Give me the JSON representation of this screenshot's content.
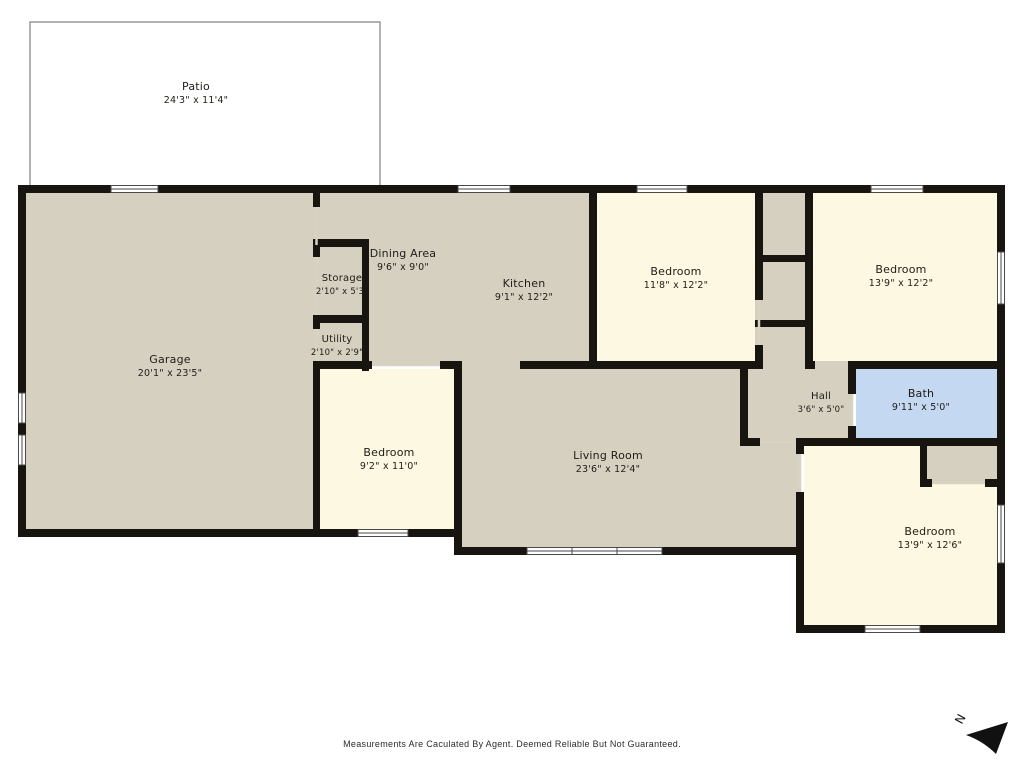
{
  "plan": {
    "rooms": {
      "patio": {
        "name": "Patio",
        "dims": "24'3\" x 11'4\""
      },
      "garage": {
        "name": "Garage",
        "dims": "20'1\" x 23'5\""
      },
      "storage": {
        "name": "Storage",
        "dims": "2'10\" x 5'3\""
      },
      "dining": {
        "name": "Dining Area",
        "dims": "9'6\" x 9'0\""
      },
      "kitchen": {
        "name": "Kitchen",
        "dims": "9'1\" x 12'2\""
      },
      "utility": {
        "name": "Utility",
        "dims": "2'10\" x 2'9\""
      },
      "bedroom_top_mid": {
        "name": "Bedroom",
        "dims": "11'8\" x 12'2\""
      },
      "bedroom_top_right": {
        "name": "Bedroom",
        "dims": "13'9\" x 12'2\""
      },
      "bedroom_lower_left": {
        "name": "Bedroom",
        "dims": "9'2\" x 11'0\""
      },
      "living": {
        "name": "Living Room",
        "dims": "23'6\" x 12'4\""
      },
      "hall": {
        "name": "Hall",
        "dims": "3'6\" x 5'0\""
      },
      "bath": {
        "name": "Bath",
        "dims": "9'11\" x 5'0\""
      },
      "bedroom_lower_right": {
        "name": "Bedroom",
        "dims": "13'9\" x 12'6\""
      }
    },
    "compass": {
      "label": "N"
    },
    "footer": {
      "disclaimer": "Measurements Are Caculated By Agent. Deemed Reliable But Not Guaranteed."
    },
    "colors": {
      "wall": "#18140f",
      "floor_tan": "#d6d0c1",
      "floor_cream": "#fdf8e2",
      "bath_blue": "#c5d8f2",
      "patio_outline": "#9a9a9a",
      "window_frame": "#4a4a4a",
      "door_line": "#d8d2c3",
      "arrow": "#111111"
    }
  }
}
